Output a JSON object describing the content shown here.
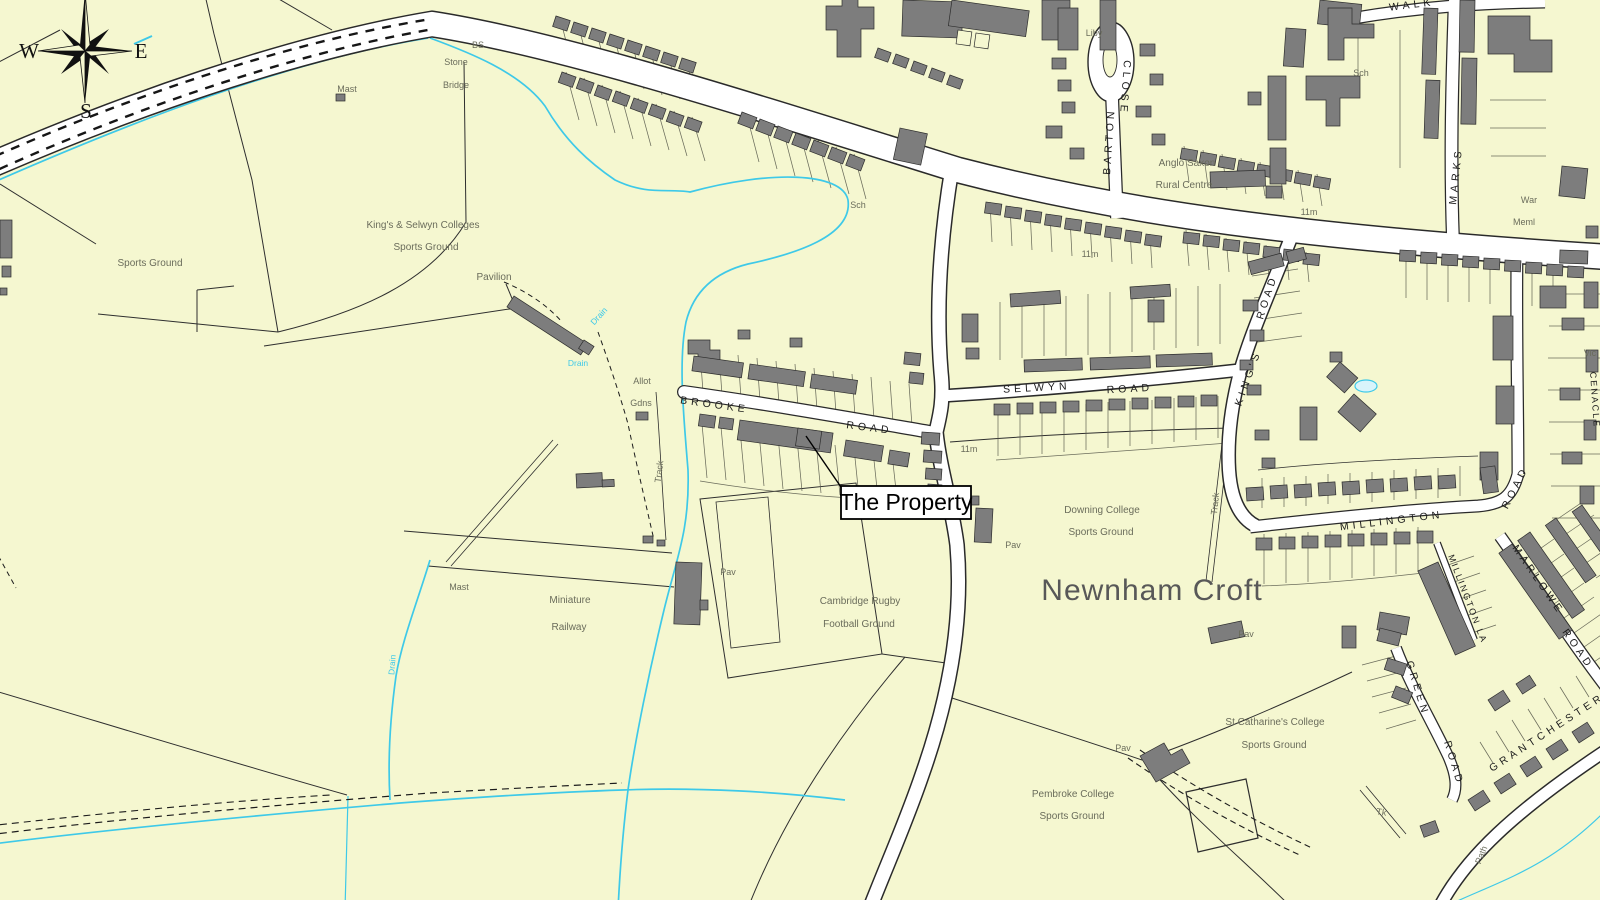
{
  "map": {
    "colors": {
      "background": "#f5f7d0",
      "road_fill": "#ffffff",
      "road_casing": "#2a2a2a",
      "building": "#7d7d7d",
      "water": "#3ec9e8",
      "feature_text": "#6a6c5b",
      "road_text": "#1c1c1c"
    },
    "annotation": {
      "property": "The Property"
    },
    "region": {
      "newnham_croft": "Newnham Croft"
    },
    "compass": {
      "west": "W",
      "east": "E",
      "south": "S"
    },
    "road_labels": {
      "brooke": "BROOKE",
      "brooke_road": "ROAD",
      "selwyn": "SELWYN",
      "selwyn_road": "ROAD",
      "kings": "KING'S",
      "kings_road": "ROAD",
      "barton": "BARTON",
      "barton_close": "CLOSE",
      "millington": "MILLINGTON",
      "millington_lane": "MILLINGTON LA",
      "ns_road": "ROAD",
      "marlowe": "MARLOWE",
      "marlowe_road": "ROAD",
      "green": "GREEN",
      "green_road": "ROAD",
      "grantchester": "GRANTCHESTER",
      "marks": "MARKS",
      "walk": "WALK",
      "cenacle": "CENACLE"
    },
    "place_labels": {
      "mast_nw": "Mast",
      "bs": "BS",
      "stone": "Stone",
      "bridge": "Bridge",
      "sports_ground_w": "Sports Ground",
      "kings_selwyn_colleges": "King's & Selwyn Colleges",
      "kings_selwyn_sports_ground": "Sports Ground",
      "pavilion": "Pavilion",
      "allot": "Allot",
      "gdns": "Gdns",
      "track_allotments": "Track",
      "sch_centre": "Sch",
      "liby": "Liby",
      "anglo_saxon": "Anglo Saxon",
      "rural_centre": "Rural Centre",
      "sch_ne": "Sch",
      "spot_11m_ne": "11m",
      "war": "War",
      "meml": "Meml",
      "spot_11m_centre": "11m",
      "vic": "Vic",
      "spot_11m_mid": "11m",
      "downing_college": "Downing College",
      "downing_sports_ground": "Sports Ground",
      "pav_downing": "Pav",
      "track_newnham": "Track",
      "pav_newnham": "Pav",
      "mast_s": "Mast",
      "miniature": "Miniature",
      "railway": "Railway",
      "pav_rugby": "Pav",
      "cambridge_rugby": "Cambridge Rugby",
      "football_ground": "Football Ground",
      "st_catharines_college": "St Catharine's College",
      "st_catharines_sports_ground": "Sports Ground",
      "pav_pembroke": "Pav",
      "pembroke_college": "Pembroke College",
      "pembroke_sports_ground": "Sports Ground",
      "tk": "Tk",
      "path": "Path"
    },
    "water_labels": {
      "drain_1": "Drain",
      "drain_2": "Drain",
      "drain_3": "Drain"
    }
  }
}
